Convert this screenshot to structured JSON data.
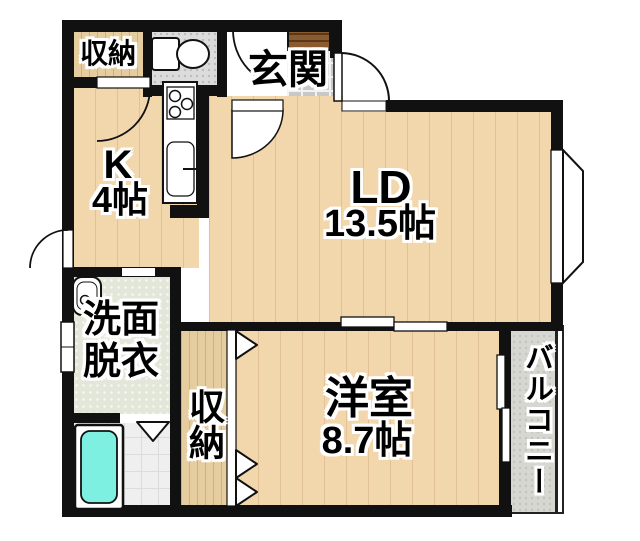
{
  "plan_type": "floor-plan",
  "rooms": {
    "storage_top": {
      "label": "収納"
    },
    "genkan": {
      "label": "玄関"
    },
    "kitchen": {
      "label": "K",
      "size": "4帖"
    },
    "ld": {
      "label": "LD",
      "size": "13.5帖"
    },
    "washroom": {
      "line1": "洗面",
      "line2": "脱衣"
    },
    "storage_bottom": {
      "label": "収納"
    },
    "western_room": {
      "label": "洋室",
      "size": "8.7帖"
    },
    "balcony": {
      "label": "バルコニー"
    }
  },
  "fixtures": [
    "toilet-icon",
    "shoe-cabinet",
    "kitchen-counter",
    "stove-burners",
    "kitchen-sink",
    "wash-basin-icon",
    "bathtub-icon",
    "bay-window",
    "entrance-door",
    "closet-folding-door",
    "bathroom-folding-door",
    "sliding-door",
    "balcony-sliding-door"
  ],
  "colors": {
    "wall": "#111111",
    "wood": "#f2d7ac",
    "closet-wood": "#e6cda0",
    "genkan-tile": "#c8c8c8",
    "toilet-floor": "#dcdcdc",
    "washroom-floor": "#e3e7d9",
    "bath-floor": "#efefef",
    "bathtub": "#7df0e2",
    "shoe-cabinet": "#8a5a30",
    "balcony-floor": "#d7d7d2",
    "text": "#000000",
    "text-outline": "#ffffff"
  }
}
